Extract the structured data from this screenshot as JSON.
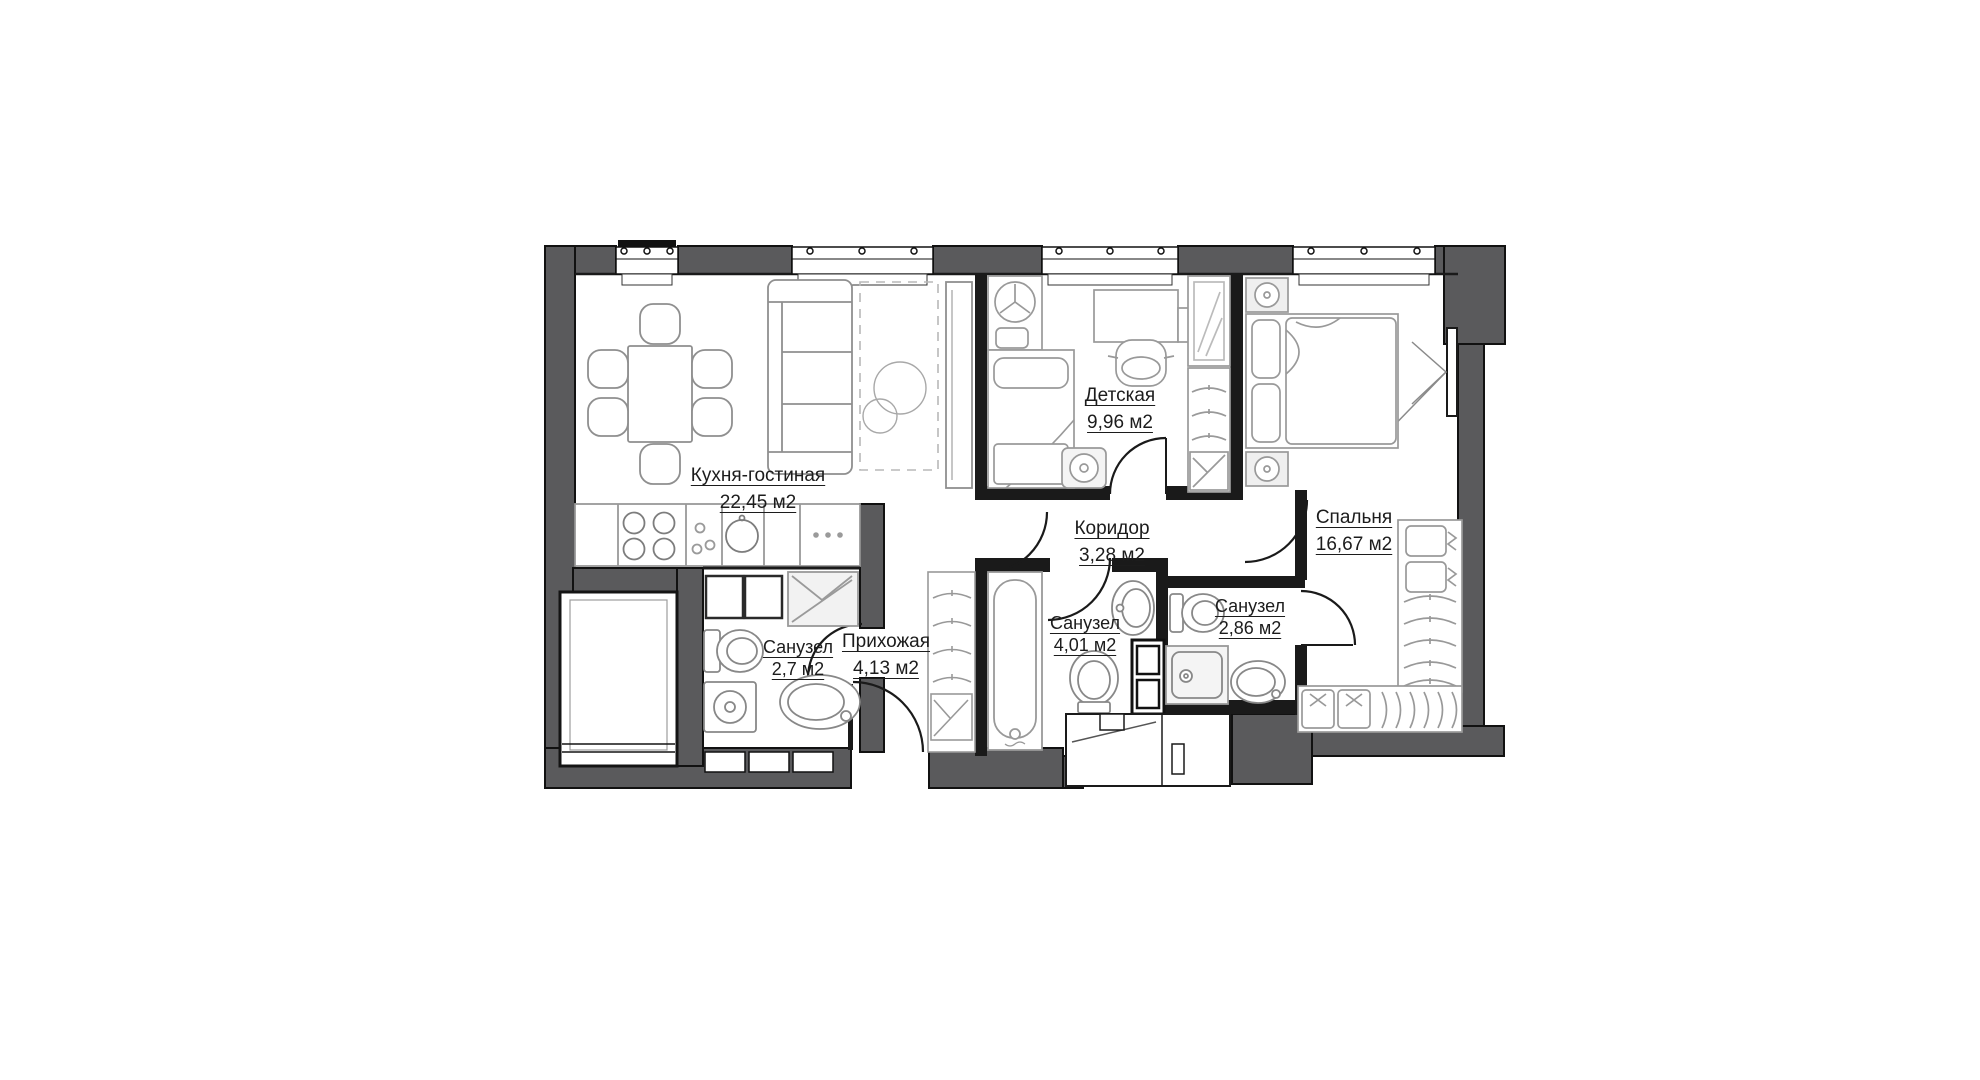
{
  "floorplan": {
    "type": "apartment-floor-plan",
    "unit": "м2",
    "top_windows": 4,
    "balcony_door": true,
    "colors": {
      "background": "#ffffff",
      "wall": "#5a5a5c",
      "wall_outline": "#111111",
      "partition": "#1a1a1a",
      "furniture_stroke": "#8f8f8f",
      "label_text": "#1c1c1c"
    },
    "rooms": [
      {
        "key": "kitchen-living",
        "name": "Кухня-гостиная",
        "area": "22,45 м2",
        "furniture": [
          "dining-table",
          "six-chairs",
          "sofa",
          "rug",
          "floor-plants",
          "tv-stand",
          "kitchen-counter",
          "cooktop-4-burner",
          "kitchen-sink"
        ]
      },
      {
        "key": "children-room",
        "name": "Детская",
        "area": "9,96 м2",
        "furniture": [
          "single-bed",
          "storage-box",
          "stool",
          "desk",
          "desk-chair",
          "shelf-unit",
          "mirror-cabinet",
          "wardrobe-hangers",
          "laundry-basket"
        ]
      },
      {
        "key": "corridor",
        "name": "Коридор",
        "area": "3,28 м2",
        "furniture": []
      },
      {
        "key": "bedroom",
        "name": "Спальня",
        "area": "16,67 м2",
        "furniture": [
          "double-bed",
          "nightstand",
          "nightstand",
          "wardrobe-hangers",
          "storage-boxes",
          "shoe-shelf",
          "balcony-door"
        ]
      },
      {
        "key": "bathroom-small",
        "name": "Санузел",
        "area": "2,7 м2",
        "furniture": [
          "toilet",
          "washing-machine",
          "sink",
          "shower-tray",
          "storage-boxes"
        ]
      },
      {
        "key": "hallway",
        "name": "Прихожая",
        "area": "4,13 м2",
        "furniture": [
          "entrance-door",
          "wardrobe-hangers",
          "laundry-basket"
        ]
      },
      {
        "key": "bathroom-main",
        "name": "Санузел",
        "area": "4,01 м2",
        "furniture": [
          "bathtub",
          "toilet",
          "sink",
          "shelving"
        ]
      },
      {
        "key": "bathroom-ensuite",
        "name": "Санузел",
        "area": "2,86 м2",
        "furniture": [
          "toilet",
          "shower-cabin",
          "sink"
        ]
      }
    ]
  }
}
